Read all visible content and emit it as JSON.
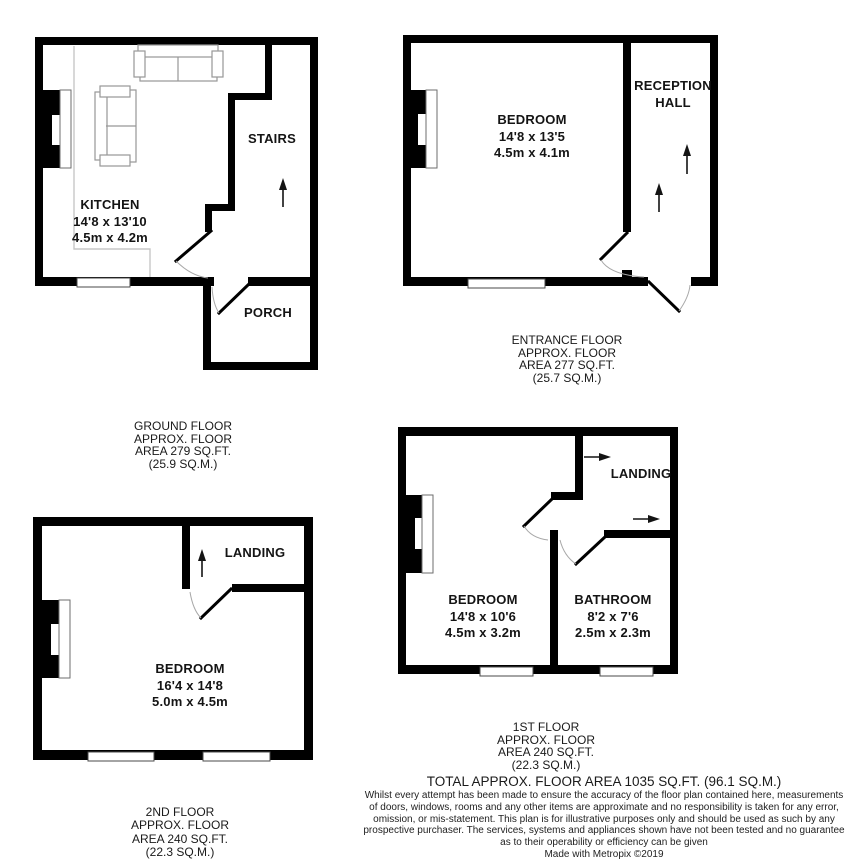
{
  "plans": {
    "ground": {
      "rooms": {
        "kitchen": {
          "name": "KITCHEN",
          "imperial": "14'8 x 13'10",
          "metric": "4.5m x 4.2m"
        },
        "stairs": {
          "name": "STAIRS"
        },
        "porch": {
          "name": "PORCH"
        }
      },
      "caption": [
        "GROUND FLOOR",
        "APPROX. FLOOR",
        "AREA 279 SQ.FT.",
        "(25.9 SQ.M.)"
      ]
    },
    "entrance": {
      "rooms": {
        "bedroom": {
          "name": "BEDROOM",
          "imperial": "14'8 x 13'5",
          "metric": "4.5m x 4.1m"
        },
        "reception_hall": {
          "line1": "RECEPTION",
          "line2": "HALL"
        }
      },
      "caption": [
        "ENTRANCE FLOOR",
        "APPROX. FLOOR",
        "AREA 277 SQ.FT.",
        "(25.7 SQ.M.)"
      ]
    },
    "first": {
      "rooms": {
        "bedroom": {
          "name": "BEDROOM",
          "imperial": "14'8 x 10'6",
          "metric": "4.5m x 3.2m"
        },
        "bathroom": {
          "name": "BATHROOM",
          "imperial": "8'2 x 7'6",
          "metric": "2.5m x 2.3m"
        },
        "landing": {
          "name": "LANDING"
        }
      },
      "caption": [
        "1ST FLOOR",
        "APPROX. FLOOR",
        "AREA 240 SQ.FT.",
        "(22.3 SQ.M.)"
      ]
    },
    "second": {
      "rooms": {
        "bedroom": {
          "name": "BEDROOM",
          "imperial": "16'4 x 14'8",
          "metric": "5.0m x 4.5m"
        },
        "landing": {
          "name": "LANDING"
        }
      },
      "caption": [
        "2ND FLOOR",
        "APPROX. FLOOR",
        "AREA 240 SQ.FT.",
        "(22.3 SQ.M.)"
      ]
    }
  },
  "footer": {
    "total": "TOTAL APPROX. FLOOR AREA 1035 SQ.FT. (96.1 SQ.M.)",
    "disclaimer": [
      "Whilst every attempt has been made to ensure the accuracy of the floor plan contained here, measurements",
      "of doors, windows, rooms and any other items are approximate and no responsibility is taken for any error,",
      "omission, or mis-statement. This plan is for illustrative purposes only and should be used as such by any",
      "prospective purchaser. The services, systems and appliances shown have not been tested and no guarantee",
      "as to their operability or efficiency can be given"
    ],
    "credit": "Made with Metropix ©2019"
  },
  "icons": {
    "up_arrow": "↑",
    "right_arrow": "→"
  },
  "colors": {
    "wall": "#000000",
    "background": "#ffffff",
    "furniture_outline": "#979797",
    "door_arc": "#a8a8a8",
    "area_line": "#c7c7c7"
  }
}
